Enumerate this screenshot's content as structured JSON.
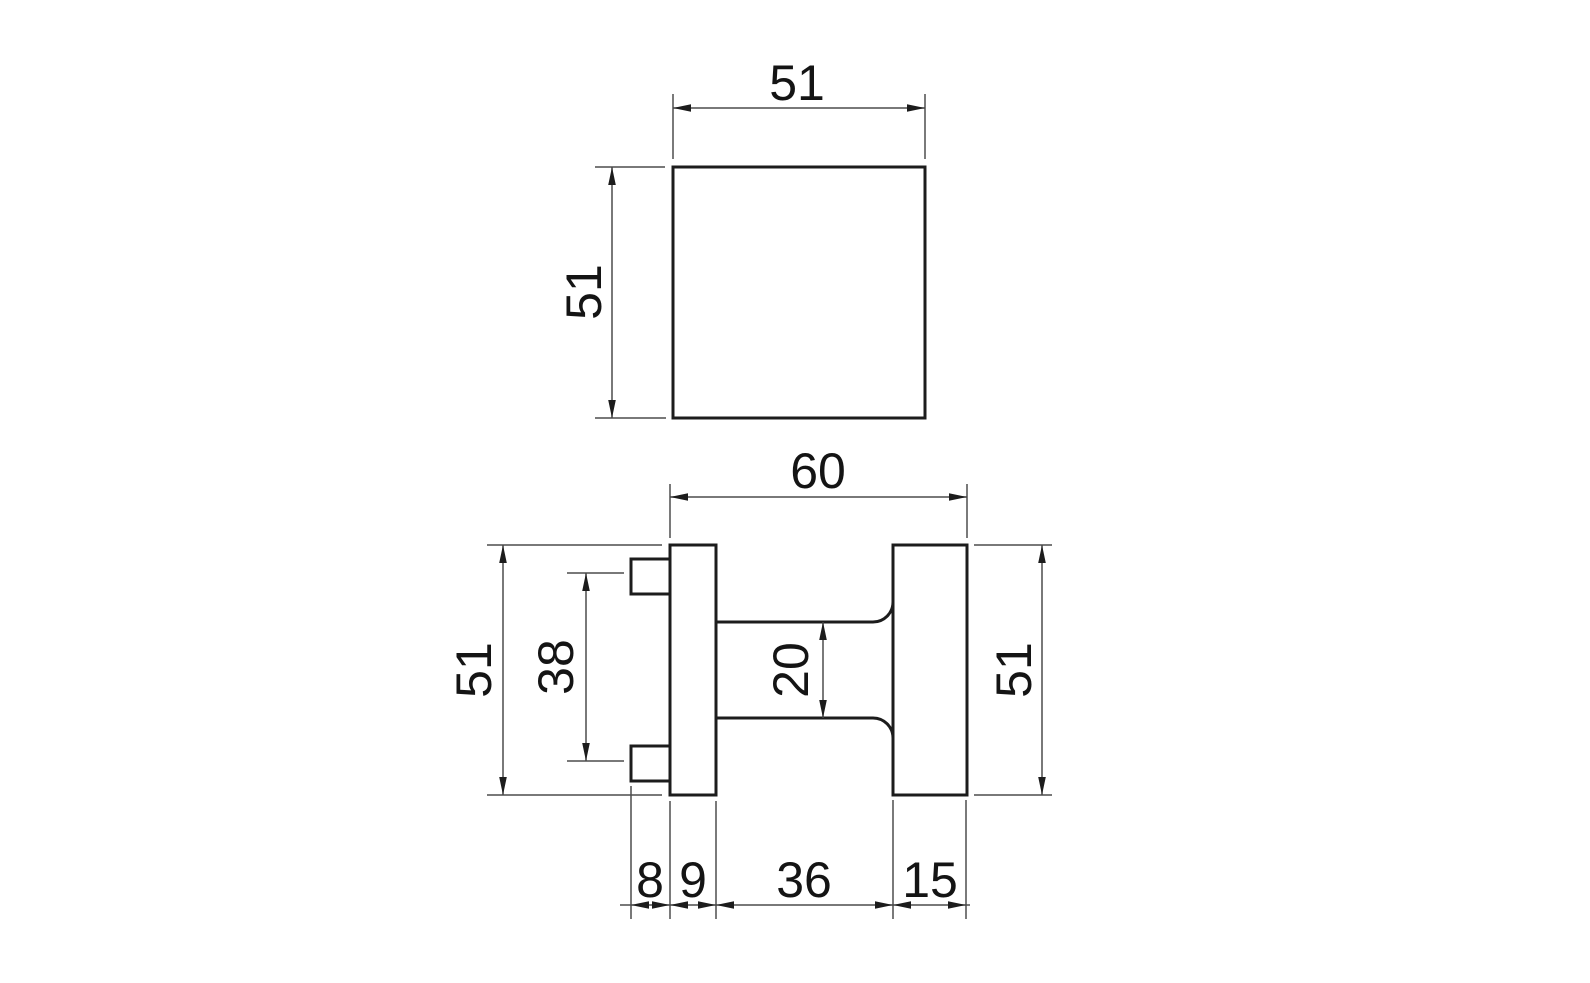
{
  "drawing": {
    "type": "technical-dimension-drawing",
    "subject": "square-door-knob-two-view-drawing",
    "colors": {
      "background": "#ffffff",
      "object_line": "#1c1c1c",
      "dimension_line": "#4d4d4d",
      "text": "#141414"
    },
    "top_view": {
      "width_mm": "51",
      "height_mm": "51"
    },
    "side_view": {
      "overall_depth_mm": "60",
      "backplate_height_mm": "51",
      "fixing_centres_mm": "38",
      "neck_height_mm": "20",
      "knob_height_mm": "51",
      "peg_depth_mm": "8",
      "backplate_thickness_mm": "9",
      "neck_length_mm": "36",
      "knob_thickness_mm": "15"
    }
  }
}
